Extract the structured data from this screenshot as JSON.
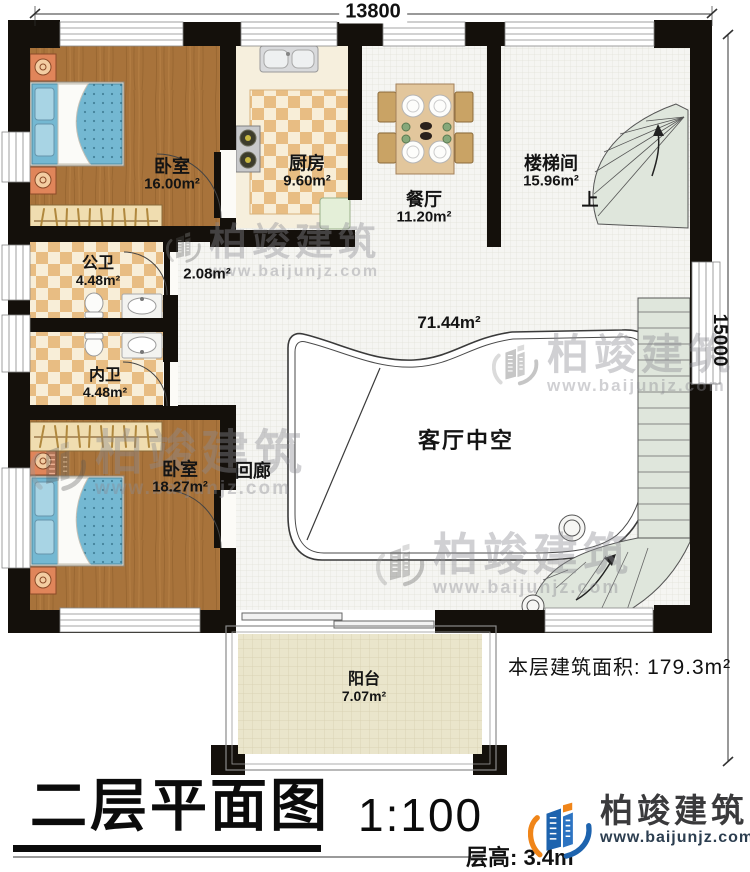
{
  "dimensions": {
    "width_mm": "13800",
    "height_mm": "15000"
  },
  "rooms": {
    "bedroom1": {
      "name": "卧室",
      "area": "16.00m²"
    },
    "kitchen": {
      "name": "厨房",
      "area": "9.60m²"
    },
    "dining": {
      "name": "餐厅",
      "area": "11.20m²"
    },
    "stairwell": {
      "name": "楼梯间",
      "area": "15.96m²",
      "direction": "上"
    },
    "bath_public": {
      "name": "公卫",
      "area": "4.48m²"
    },
    "hallway": {
      "area": "2.08m²"
    },
    "bath_private": {
      "name": "内卫",
      "area": "4.48m²"
    },
    "bedroom2": {
      "name": "卧室",
      "area": "18.27m²"
    },
    "corridor": {
      "name": "回廊"
    },
    "living_void": {
      "name": "客厅中空",
      "area": "71.44m²"
    },
    "balcony": {
      "name": "阳台",
      "area": "7.07m²"
    }
  },
  "titleblock": {
    "plan_title": "二层平面图",
    "scale": "1:100",
    "floor_height": "层高: 3.4m",
    "floor_area_label": "本层建筑面积:",
    "floor_area_value": "179.3m²"
  },
  "brand": {
    "company": "柏竣建筑",
    "website": "www.baijunjz.com"
  },
  "watermark": {
    "company": "柏竣建筑",
    "website": "www.baijunjz.com"
  },
  "colors": {
    "wall": "#14100b",
    "wood_floor": "#a8733b",
    "tile_dark": "#e8bd83",
    "tile_light": "#f8eed8",
    "grid_floor": "#f5f5f2",
    "stair": "#dfe6dc",
    "balcony_floor": "#eae5cb",
    "bed": "#74b8d2",
    "brand_blue": "#1d63ae",
    "brand_orange": "#f08519"
  }
}
